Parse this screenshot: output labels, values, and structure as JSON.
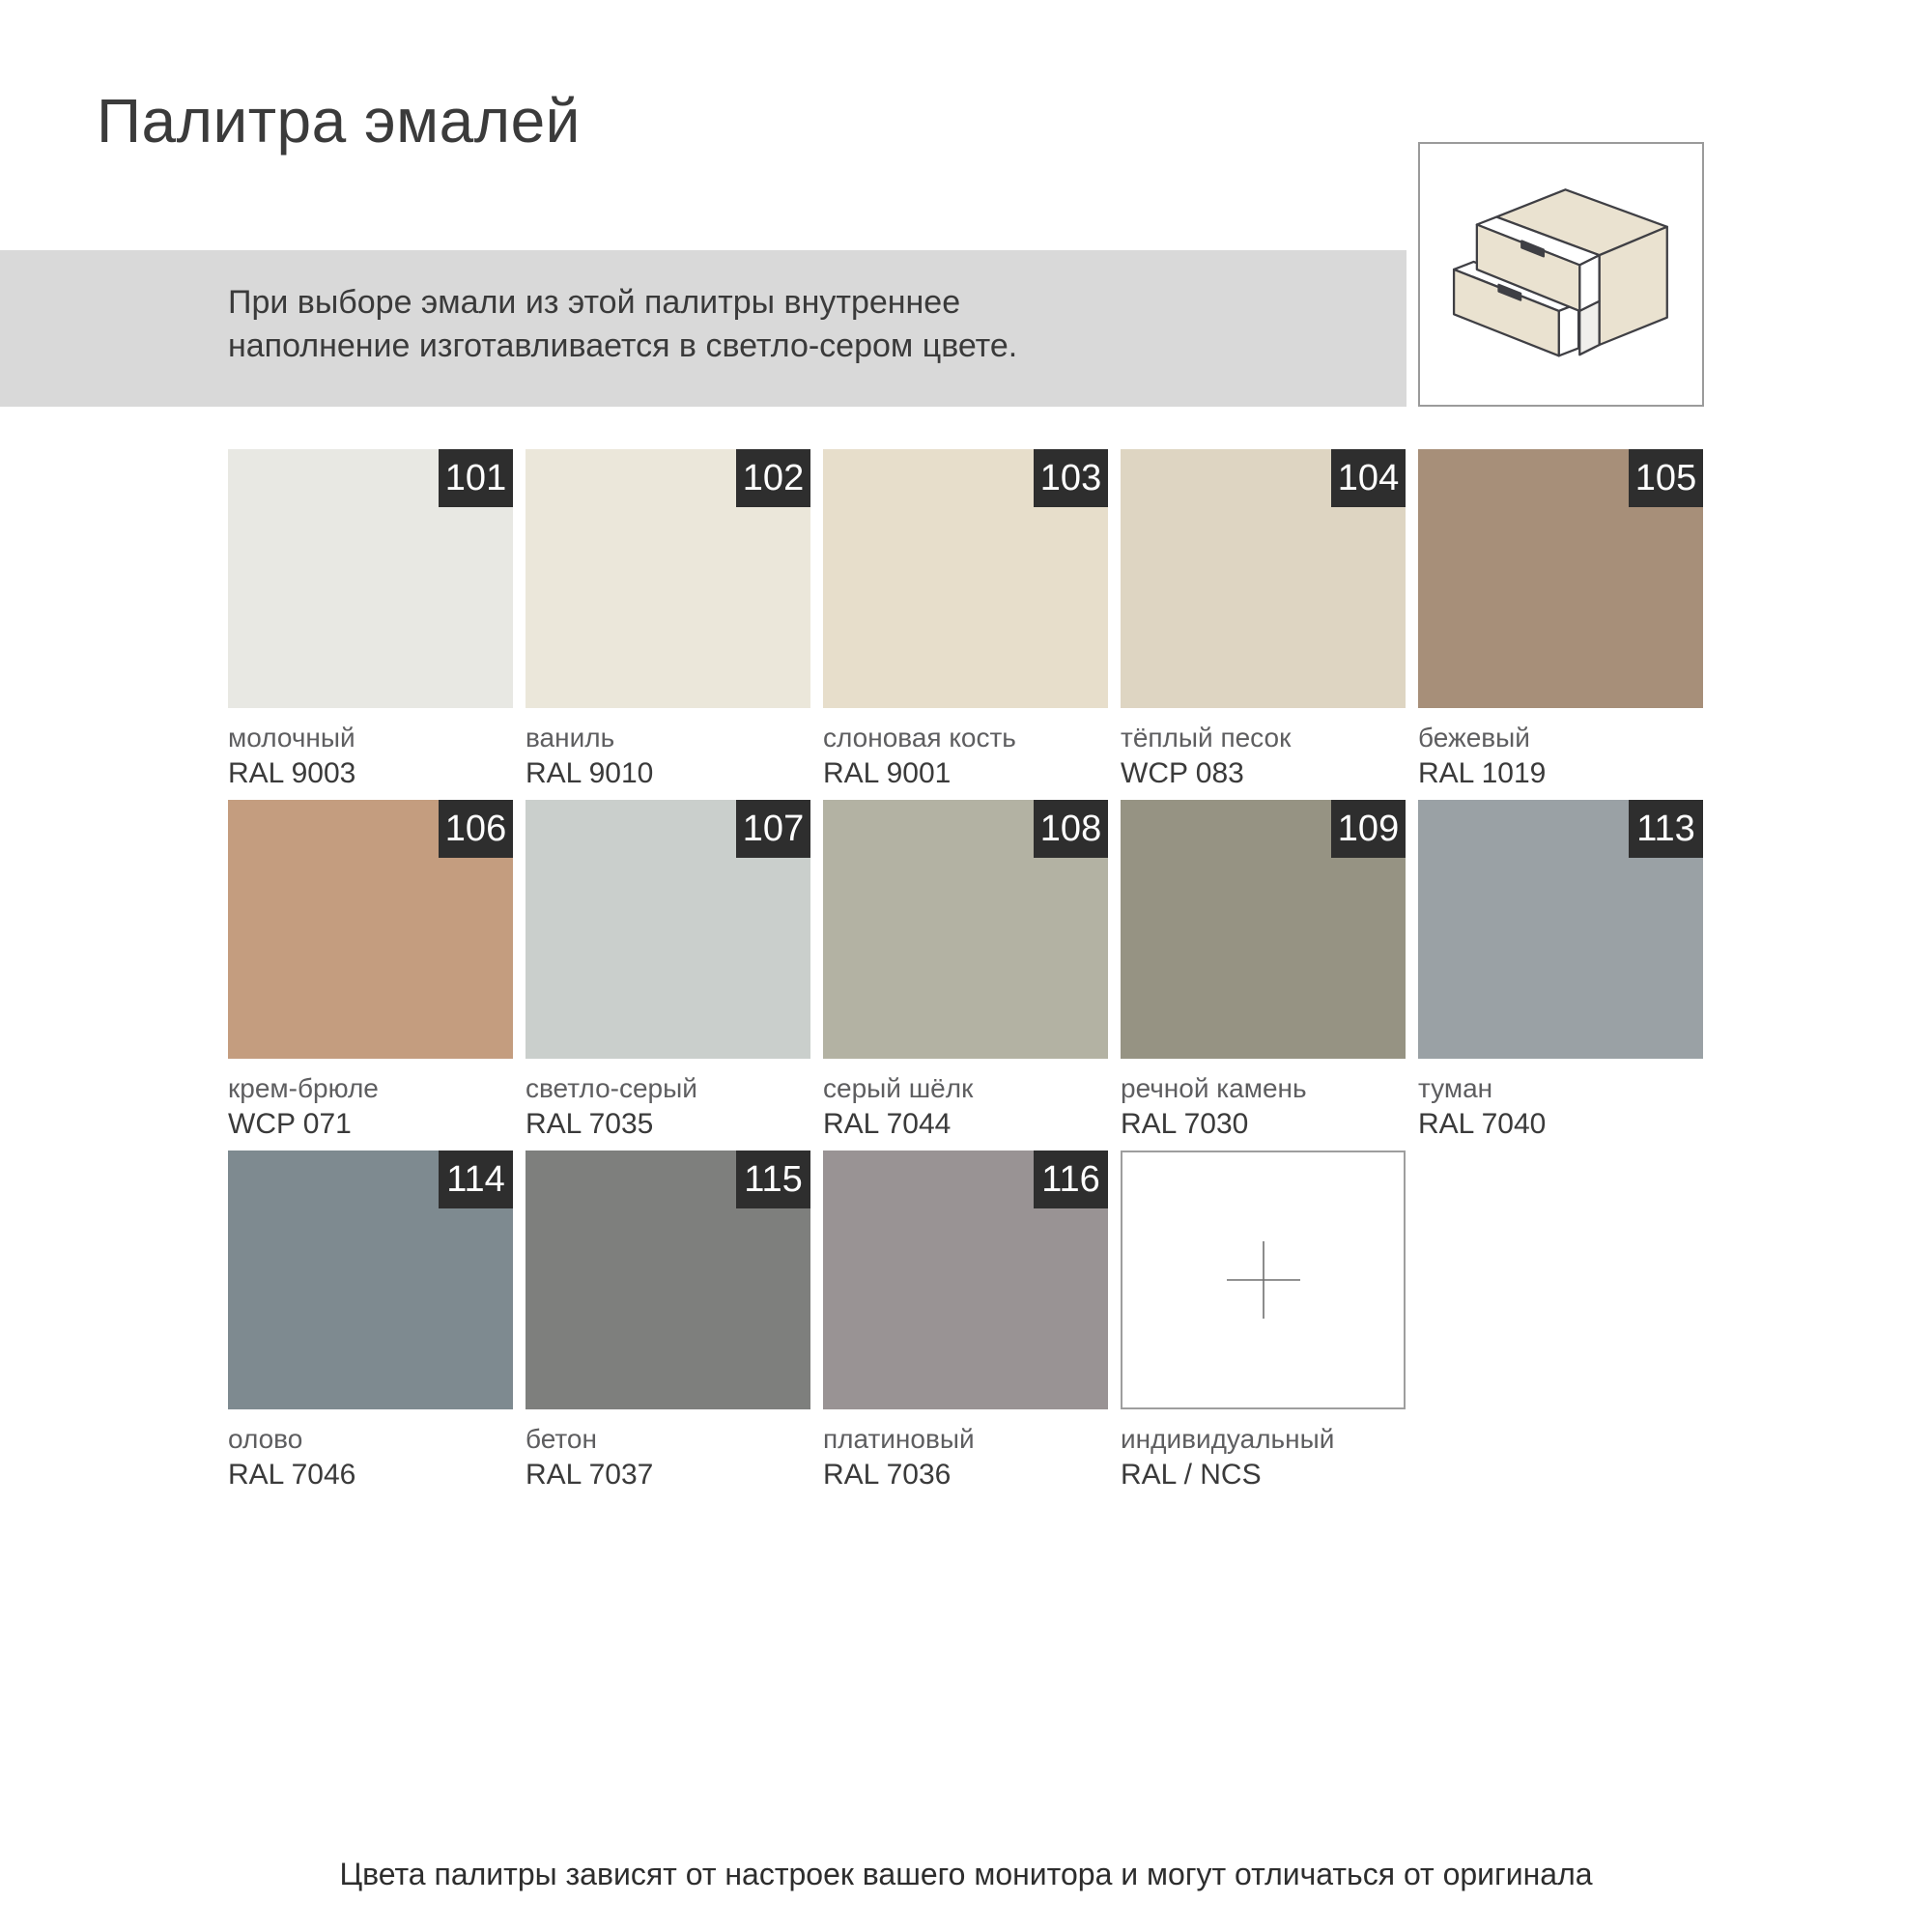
{
  "page": {
    "title": "Палитра эмалей",
    "banner": {
      "line1": "При выборе эмали из этой палитры внутреннее",
      "line2": "наполнение изготавливается в светло-сером цвете."
    },
    "footer": "Цвета палитры зависят от настроек вашего монитора и могут отличаться от оригинала"
  },
  "theme": {
    "banner_bg": "#d9d9d9",
    "badge_bg": "#2e2e2e",
    "badge_fg": "#ffffff",
    "title_color": "#3b3b3b",
    "label_name_color": "#5e5e60",
    "label_code_color": "#3a3a3a"
  },
  "illustration": {
    "name": "two-drawer-cabinet",
    "body_color": "#eae2d0",
    "inner_color": "#ffffff",
    "outline_color": "#3f3f44",
    "frame_border_color": "#9b9b9b"
  },
  "swatches": [
    {
      "number": "101",
      "name": "молочный",
      "code": "RAL 9003",
      "hex": "#e8e8e3"
    },
    {
      "number": "102",
      "name": "ваниль",
      "code": "RAL 9010",
      "hex": "#ebe7da"
    },
    {
      "number": "103",
      "name": "слоновая кость",
      "code": "RAL 9001",
      "hex": "#e7decb"
    },
    {
      "number": "104",
      "name": "тёплый песок",
      "code": "WCP 083",
      "hex": "#ded5c2"
    },
    {
      "number": "105",
      "name": "бежевый",
      "code": "RAL 1019",
      "hex": "#a78f79"
    },
    {
      "number": "106",
      "name": "крем-брюле",
      "code": "WCP 071",
      "hex": "#c49d7f"
    },
    {
      "number": "107",
      "name": "светло-серый",
      "code": "RAL 7035",
      "hex": "#cacfcc"
    },
    {
      "number": "108",
      "name": "серый шёлк",
      "code": "RAL 7044",
      "hex": "#b3b2a3"
    },
    {
      "number": "109",
      "name": "речной камень",
      "code": "RAL 7030",
      "hex": "#969383"
    },
    {
      "number": "113",
      "name": "туман",
      "code": "RAL 7040",
      "hex": "#9aa1a5"
    },
    {
      "number": "114",
      "name": "олово",
      "code": "RAL 7046",
      "hex": "#7e8a90"
    },
    {
      "number": "115",
      "name": "бетон",
      "code": "RAL 7037",
      "hex": "#7e7f7d"
    },
    {
      "number": "116",
      "name": "платиновый",
      "code": "RAL 7036",
      "hex": "#999394"
    },
    {
      "number": null,
      "name": "индивидуальный",
      "code": "RAL / NCS",
      "hex": "#ffffff",
      "custom": true
    }
  ]
}
